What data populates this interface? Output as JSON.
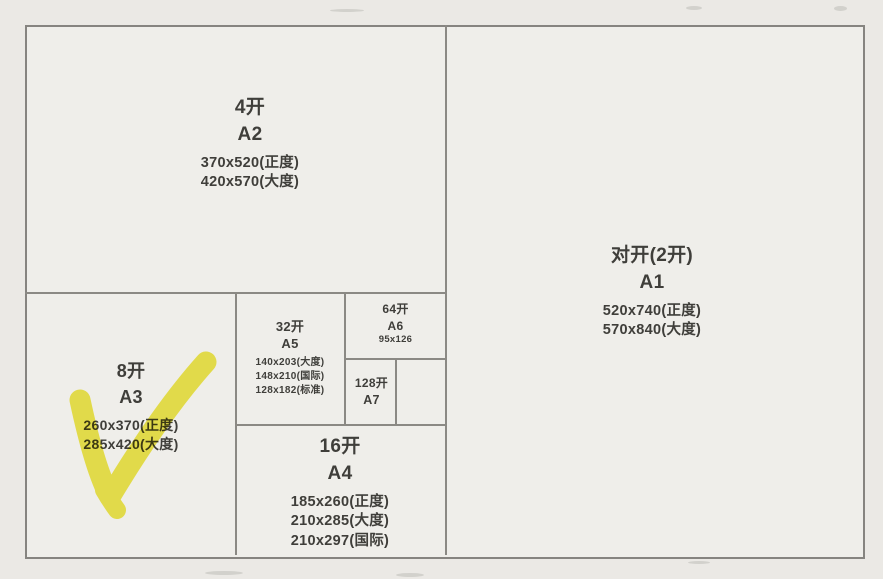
{
  "title": "纸张开数与国际标准尺寸对照图",
  "colors": {
    "background": "#ebe9e5",
    "line": "#8b8984",
    "text": "#3f3e3a",
    "highlight": "#f0e838"
  },
  "sections": {
    "a2": {
      "kai": "4开",
      "series": "A2",
      "sizes": [
        "370x520(正度)",
        "420x570(大度)"
      ]
    },
    "a1": {
      "kai": "对开(2开)",
      "series": "A1",
      "sizes": [
        "520x740(正度)",
        "570x840(大度)"
      ]
    },
    "a3": {
      "kai": "8开",
      "series": "A3",
      "sizes": [
        "260x370(正度)",
        "285x420(大度)"
      ]
    },
    "a5": {
      "kai": "32开",
      "series": "A5",
      "sizes": [
        "140x203(大度)",
        "148x210(国际)",
        "128x182(标准)"
      ]
    },
    "a6": {
      "kai": "64开",
      "series": "A6",
      "sizes": [
        "95x126"
      ]
    },
    "a7": {
      "kai": "128开",
      "series": "A7",
      "sizes": []
    },
    "a4": {
      "kai": "16开",
      "series": "A4",
      "sizes": [
        "185x260(正度)",
        "210x285(大度)",
        "210x297(国际)"
      ]
    }
  },
  "annotation": {
    "type": "highlighter-checkmark",
    "target": "8开 A3",
    "color": "#f0e838"
  }
}
